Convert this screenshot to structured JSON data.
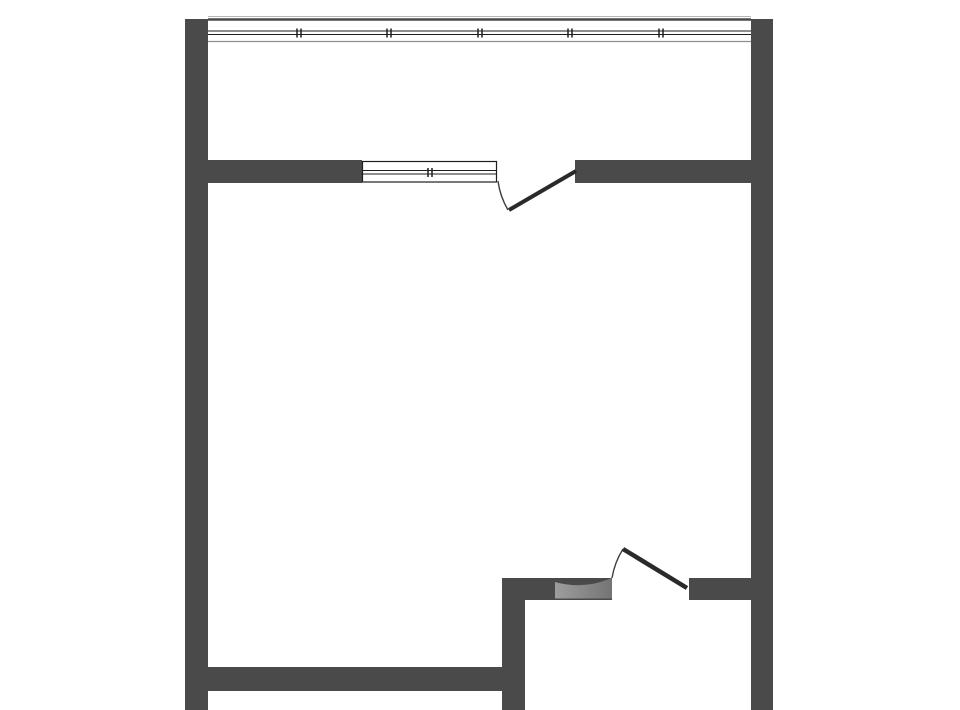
{
  "canvas": {
    "width": 960,
    "height": 710,
    "background": "#ffffff"
  },
  "colors": {
    "wall": "#4a4a4a",
    "line_dark": "#1e1e1e",
    "line_gray": "#8f8f8f",
    "line_light": "#b5b5b5",
    "door_leaf": "#2a2a2a",
    "arc_line": "#3f3f3f",
    "swing_shade_from": "#9e9e9e",
    "swing_shade_to": "#747474"
  },
  "walls": [
    {
      "name": "left-exterior-wall",
      "x": 185,
      "y": 19,
      "w": 23,
      "h": 691
    },
    {
      "name": "right-exterior-wall",
      "x": 751,
      "y": 19,
      "w": 22,
      "h": 691
    },
    {
      "name": "balcony-partition-wall-left",
      "x": 208,
      "y": 160,
      "w": 154,
      "h": 23
    },
    {
      "name": "balcony-partition-wall-right",
      "x": 575,
      "y": 160,
      "w": 176,
      "h": 23
    },
    {
      "name": "entry-wall-left-of-door",
      "x": 502,
      "y": 578,
      "w": 110,
      "h": 22
    },
    {
      "name": "entry-wall-right-of-door",
      "x": 689,
      "y": 578,
      "w": 62,
      "h": 22
    },
    {
      "name": "interior-vertical-wall",
      "x": 502,
      "y": 578,
      "w": 23,
      "h": 132
    },
    {
      "name": "bottom-interior-wall",
      "x": 208,
      "y": 667,
      "w": 294,
      "h": 24
    }
  ],
  "windows": {
    "balcony_strip": {
      "x1": 208,
      "x2": 751,
      "highlight_y": 16.5,
      "top_y": 19.5,
      "top_width": 2.5,
      "glass_y1": 31,
      "glass_y2": 34.5,
      "bottom_y": 41.5,
      "mullions": [
        299,
        389,
        480,
        570,
        661
      ],
      "tick_top": 28.5,
      "tick_bottom": 37.5,
      "tick_gap": 4
    },
    "room_window": {
      "x1": 362.5,
      "x2": 496.5,
      "top_y": 161.5,
      "bottom_y": 182,
      "glass_y1": 170.5,
      "glass_y2": 174,
      "mullions": [
        430
      ],
      "tick_top": 168,
      "tick_bottom": 177,
      "tick_gap": 4
    }
  },
  "doors": {
    "balcony_door": {
      "leaf": {
        "x1": 576,
        "y1": 171,
        "x2": 509,
        "y2": 210
      },
      "arc_path": "M498,181 A77,77 0 0 0 508,210"
    },
    "entry_door": {
      "leaf": {
        "x1": 687,
        "y1": 588,
        "x2": 623,
        "y2": 549
      },
      "arc_path": "M612,578 A78,78 0 0 1 623,549",
      "shade_path": "M555,582 Q584,590 612,578 L612,598.5 L555,598.5 Z"
    }
  }
}
